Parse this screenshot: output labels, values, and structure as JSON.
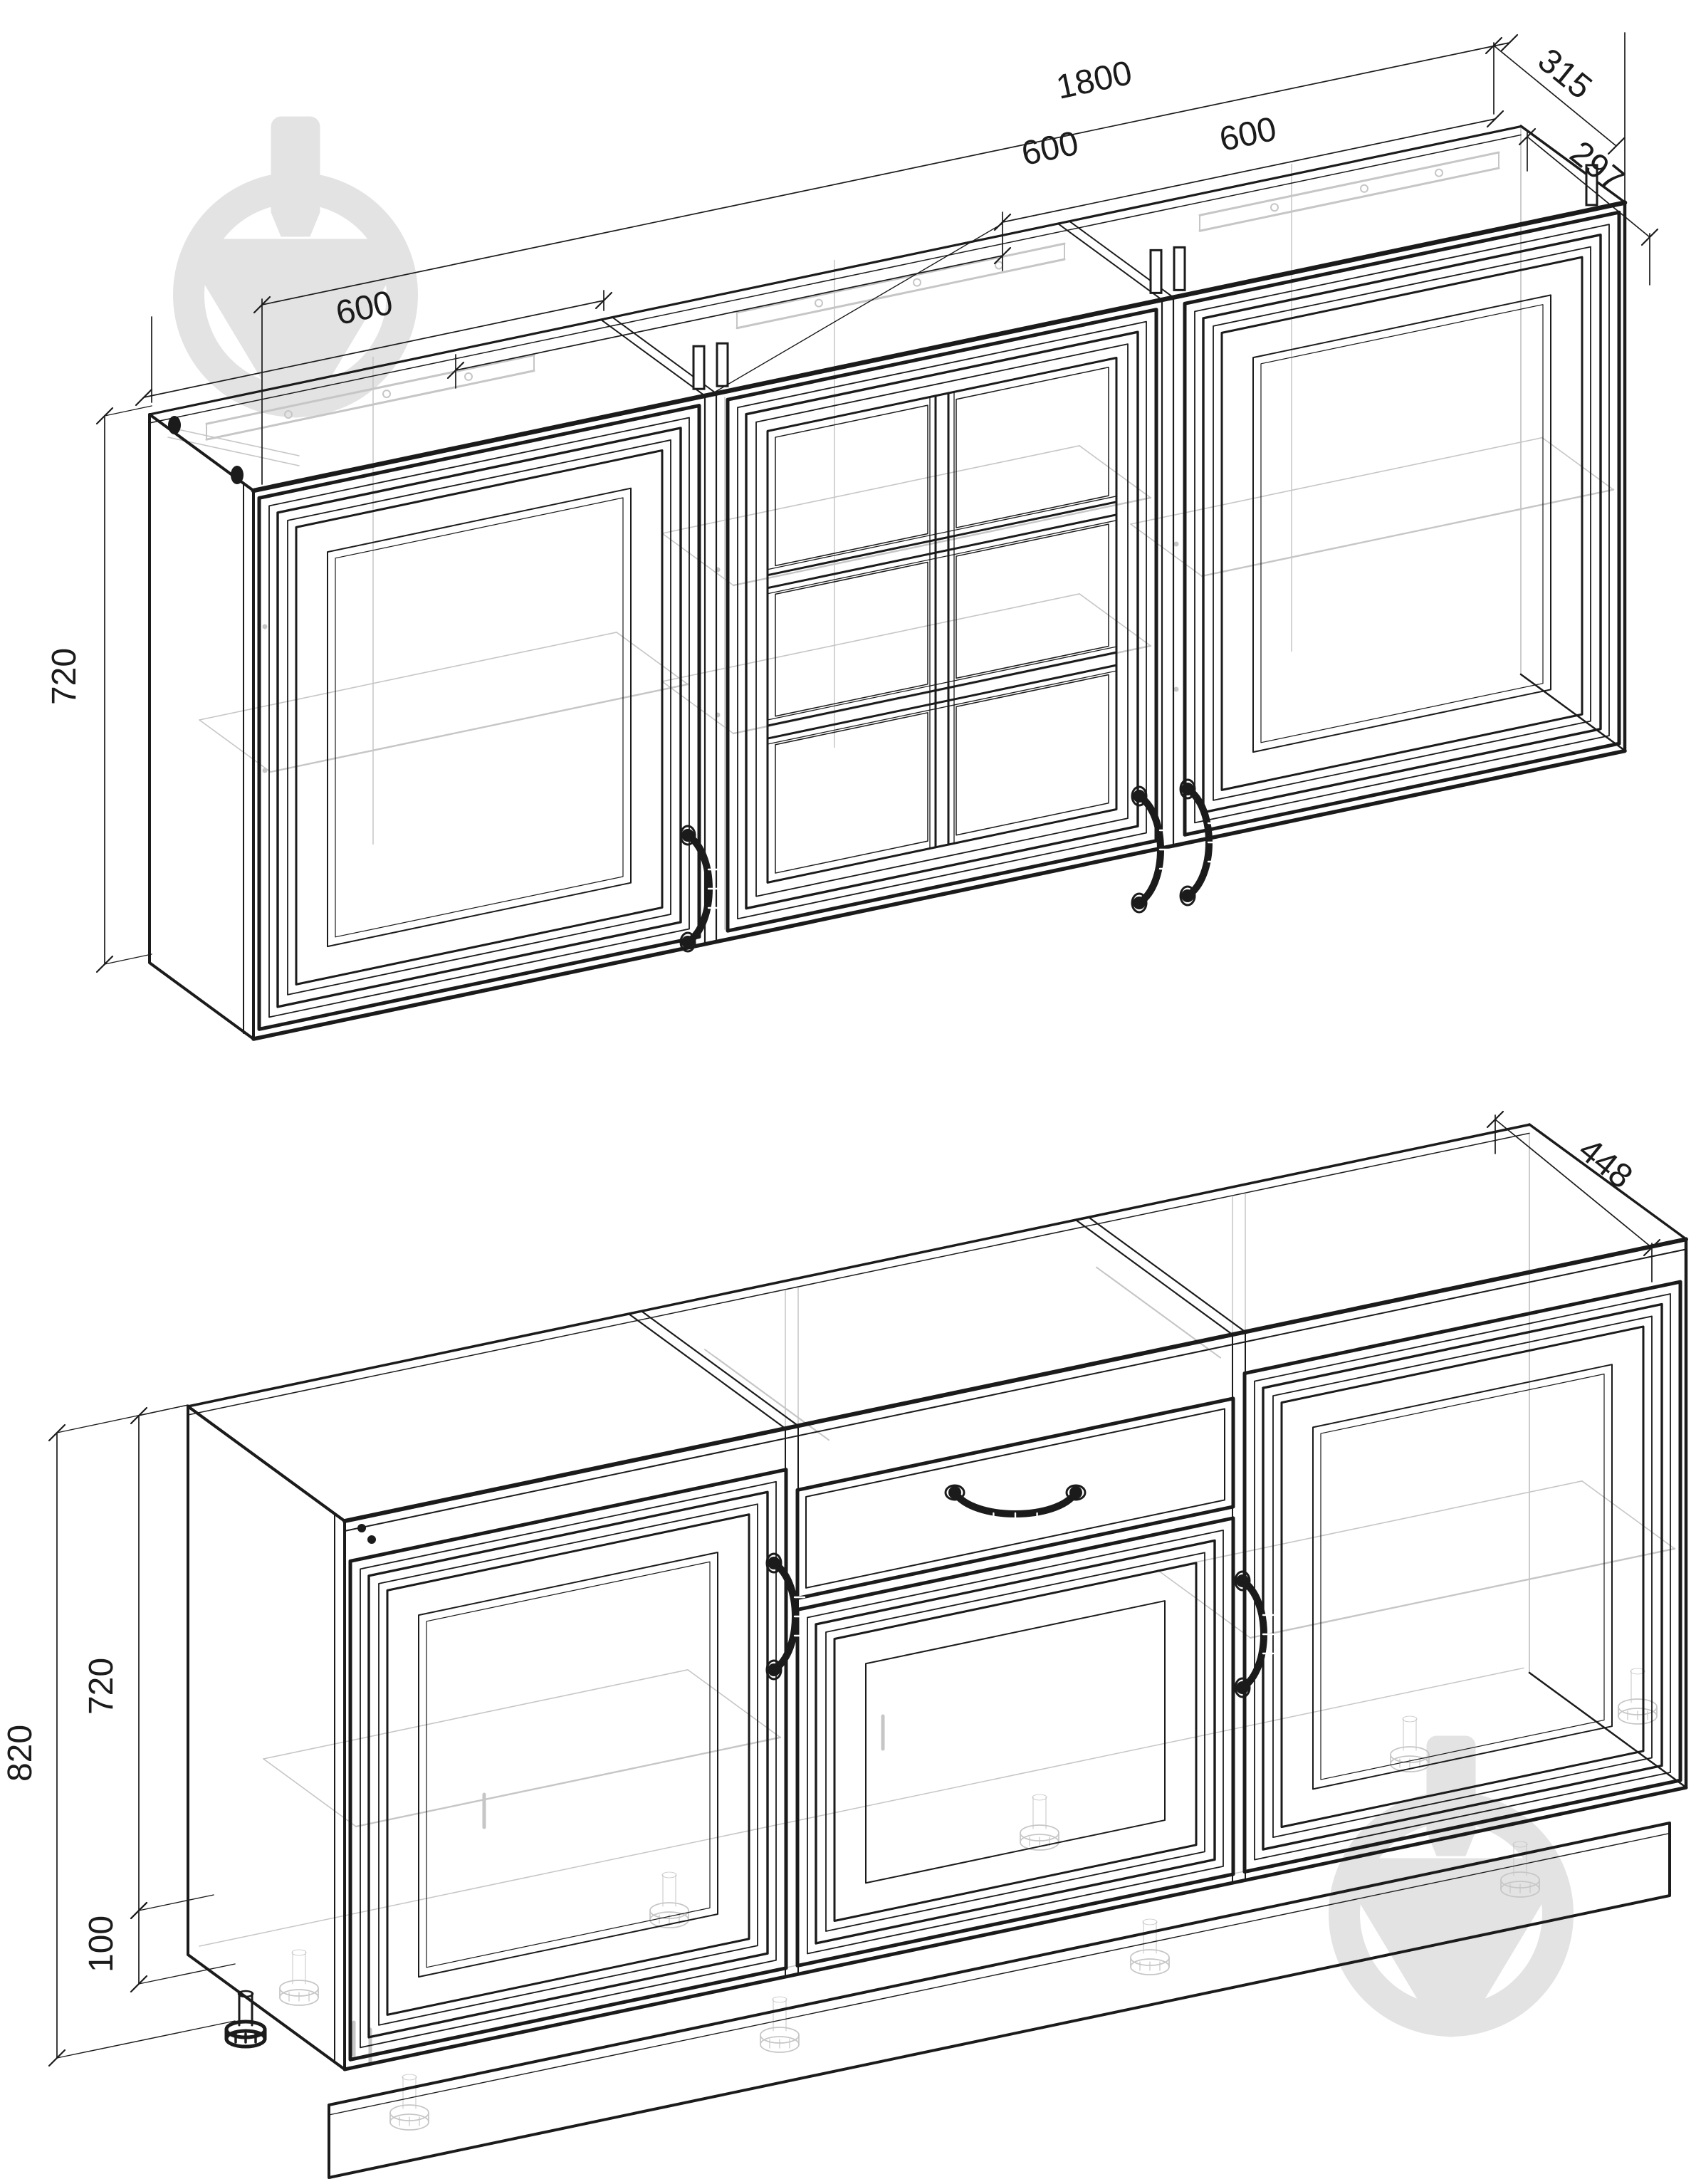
{
  "document": {
    "type": "kitchen-set-technical-drawing",
    "views": [
      "wall-cabinets-row",
      "base-cabinets-row"
    ]
  },
  "colors": {
    "line": "#1b1b1b",
    "hidden": "#c6c6c6",
    "watermark": "#e3e3e3",
    "background": "#ffffff"
  },
  "watermark": {
    "icon": "spinning-top-logo"
  },
  "upper_row": {
    "total_width_mm": 1800,
    "section_widths_mm": [
      600,
      600,
      600
    ],
    "height_mm": 720,
    "depth_with_facade_mm": 315,
    "depth_body_mm": 297,
    "doors": [
      "framed-panel",
      "glass-2x3",
      "framed-panel"
    ]
  },
  "lower_row": {
    "total_height_mm": 820,
    "body_height_mm": 720,
    "legs_height_mm": 100,
    "depth_mm": 448,
    "features": [
      "framed-door",
      "drawer-and-door",
      "framed-door"
    ]
  },
  "labels": {
    "upper_left_width": "600",
    "upper_total_width": "1800",
    "upper_mid_width": "600",
    "upper_right_width": "600",
    "depth_facade": "315",
    "depth_body": "297",
    "upper_height": "720",
    "lower_depth": "448",
    "lower_total_height": "820",
    "lower_body_height": "720",
    "lower_legs_height": "100"
  }
}
